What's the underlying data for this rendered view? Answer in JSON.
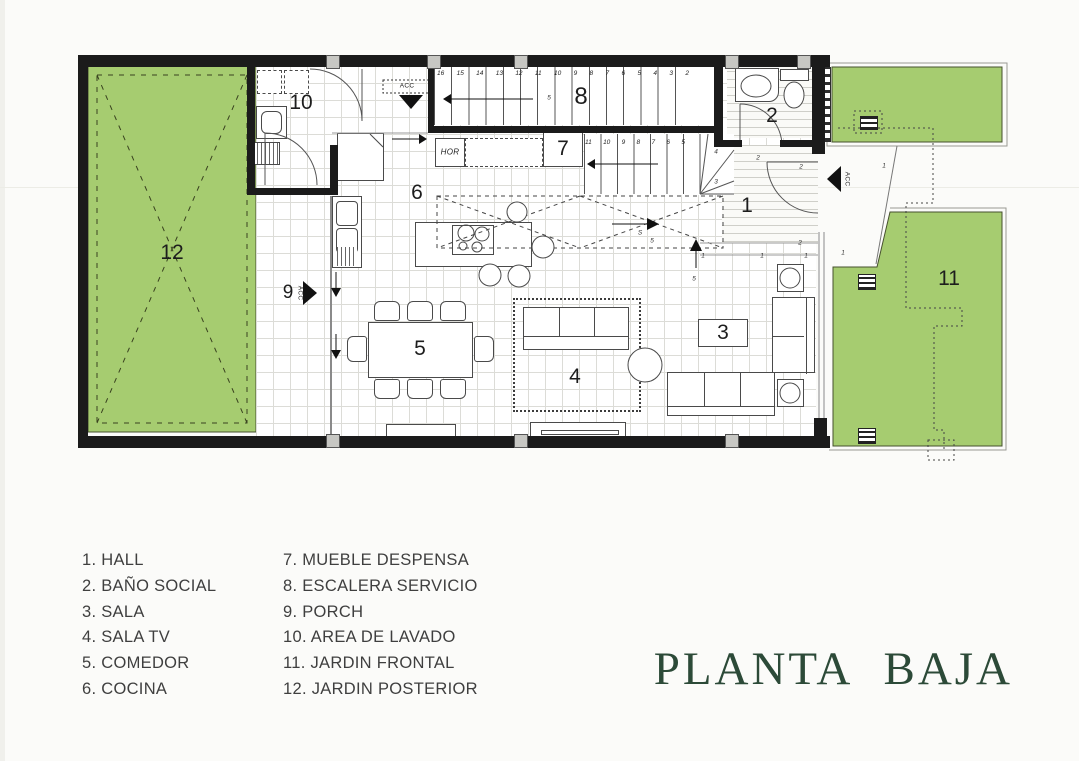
{
  "title": {
    "text": "PLANTA BAJA",
    "color": "#2c4a38"
  },
  "colors": {
    "garden_green": "#a6cc70",
    "wall_black": "#1b1b1b",
    "grid_gray": "#dcdcd7"
  },
  "legend": {
    "col1": [
      "1. HALL",
      "2. BAÑO SOCIAL",
      "3. SALA",
      "4. SALA TV",
      "5. COMEDOR",
      "6. COCINA"
    ],
    "col2": [
      "7. MUEBLE DESPENSA",
      "8. ESCALERA SERVICIO",
      "9. PORCH",
      "10. AREA DE LAVADO",
      "11. JARDIN FRONTAL",
      "12. JARDIN POSTERIOR"
    ]
  },
  "rooms": {
    "hall": "1",
    "bano_social": "2",
    "sala": "3",
    "sala_tv": "4",
    "comedor": "5",
    "cocina": "6",
    "mueble_despensa": "7",
    "escalera_servicio": "8",
    "porch": "9",
    "area_de_lavado": "10",
    "jardin_frontal": "11",
    "jardin_posterior": "12"
  },
  "annotations": {
    "acc": "ACC",
    "hor": "HOR",
    "s": "S"
  },
  "stairs": {
    "service_steps": [
      "16",
      "15",
      "14",
      "13",
      "12",
      "11",
      "10",
      "9",
      "8",
      "7",
      "6",
      "5",
      "4",
      "3",
      "2"
    ],
    "main_steps": [
      "11",
      "10",
      "9",
      "8",
      "7",
      "6",
      "5"
    ],
    "winder_steps": [
      "4",
      "3"
    ]
  },
  "micro_marks": [
    {
      "t": "2",
      "x": 801,
      "y": 167
    },
    {
      "t": "1",
      "x": 884,
      "y": 166
    },
    {
      "t": "2",
      "x": 800,
      "y": 243
    },
    {
      "t": "1",
      "x": 762,
      "y": 256
    },
    {
      "t": "1",
      "x": 806,
      "y": 256
    },
    {
      "t": "1",
      "x": 843,
      "y": 253
    },
    {
      "t": "5",
      "x": 549,
      "y": 98
    },
    {
      "t": "S",
      "x": 640,
      "y": 233
    },
    {
      "t": "5",
      "x": 694,
      "y": 279
    },
    {
      "t": "5",
      "x": 652,
      "y": 241
    },
    {
      "t": "2",
      "x": 758,
      "y": 158
    },
    {
      "t": "1",
      "x": 703,
      "y": 256
    }
  ]
}
